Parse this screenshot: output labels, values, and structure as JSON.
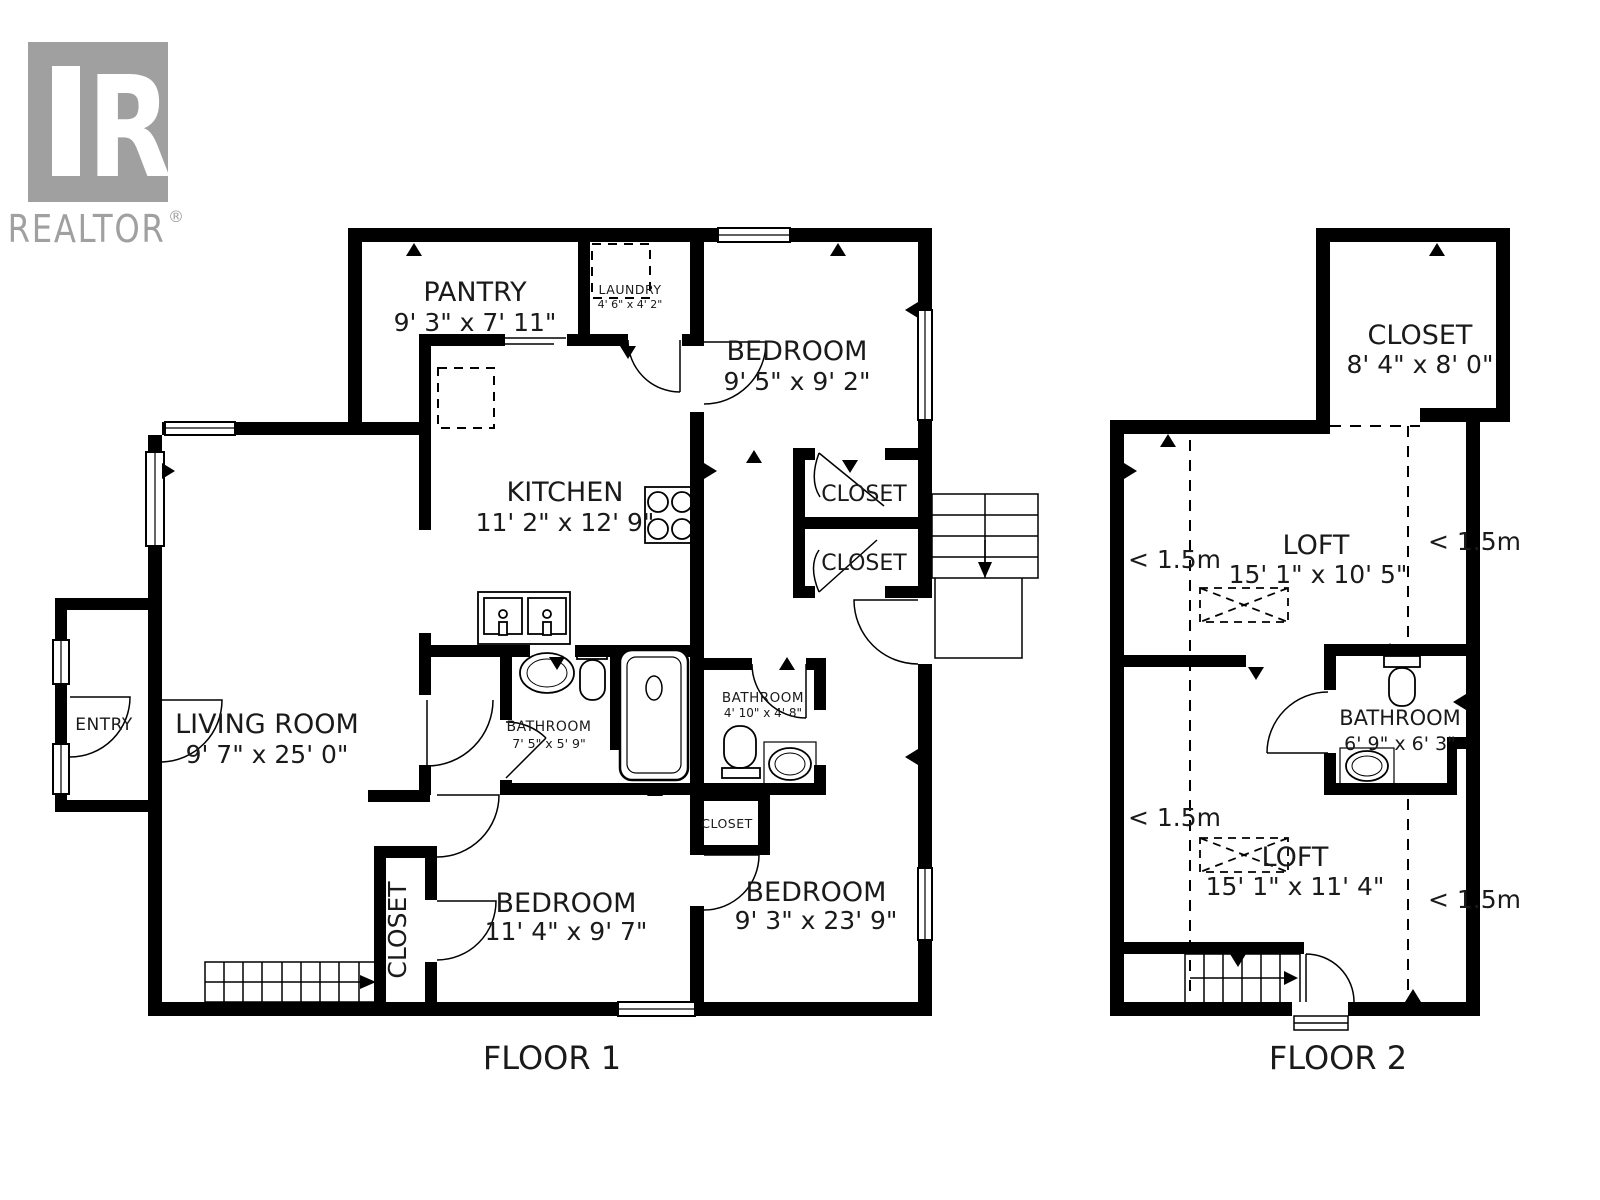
{
  "brand": {
    "name": "REALTOR",
    "registered": "®",
    "logo_letter": "R",
    "color": "#a0a0a0"
  },
  "palette": {
    "wall": "#000000",
    "text": "#1a1a1a",
    "background": "#ffffff"
  },
  "floor1": {
    "caption": "FLOOR 1",
    "rooms": {
      "pantry": {
        "name": "PANTRY",
        "size": "9' 3\" x 7' 11\""
      },
      "laundry": {
        "name": "LAUNDRY",
        "size": "4' 6\" x 4' 2\""
      },
      "bedroom_top": {
        "name": "BEDROOM",
        "size": "9' 5\" x 9' 2\""
      },
      "kitchen": {
        "name": "KITCHEN",
        "size": "11' 2\" x 12' 9\""
      },
      "closet_upper": {
        "name": "CLOSET"
      },
      "closet_lower": {
        "name": "CLOSET"
      },
      "entry": {
        "name": "ENTRY"
      },
      "living": {
        "name": "LIVING ROOM",
        "size": "9' 7\" x 25' 0\""
      },
      "bathroom_main": {
        "name": "BATHROOM",
        "size": "7' 5\" x 5' 9\""
      },
      "bathroom_small": {
        "name": "BATHROOM",
        "size": "4' 10\" x 4' 8\""
      },
      "closet_hall": {
        "name": "CLOSET"
      },
      "closet_stairs": {
        "name": "CLOSET"
      },
      "bedroom_left": {
        "name": "BEDROOM",
        "size": "11' 4\" x 9' 7\""
      },
      "bedroom_right": {
        "name": "BEDROOM",
        "size": "9' 3\" x 23' 9\""
      }
    }
  },
  "floor2": {
    "caption": "FLOOR 2",
    "rooms": {
      "closet": {
        "name": "CLOSET",
        "size": "8' 4\" x 8' 0\""
      },
      "loft_upper": {
        "name": "LOFT",
        "size": "15' 1\" x 10' 5\""
      },
      "bathroom": {
        "name": "BATHROOM",
        "size": "6' 9\" x 6' 3\""
      },
      "loft_lower": {
        "name": "LOFT",
        "size": "15' 1\" x 11' 4\""
      }
    },
    "markers": {
      "upper_left": "< 1.5m",
      "upper_right": "< 1.5m",
      "lower_left": "< 1.5m",
      "lower_right": "< 1.5m"
    }
  }
}
